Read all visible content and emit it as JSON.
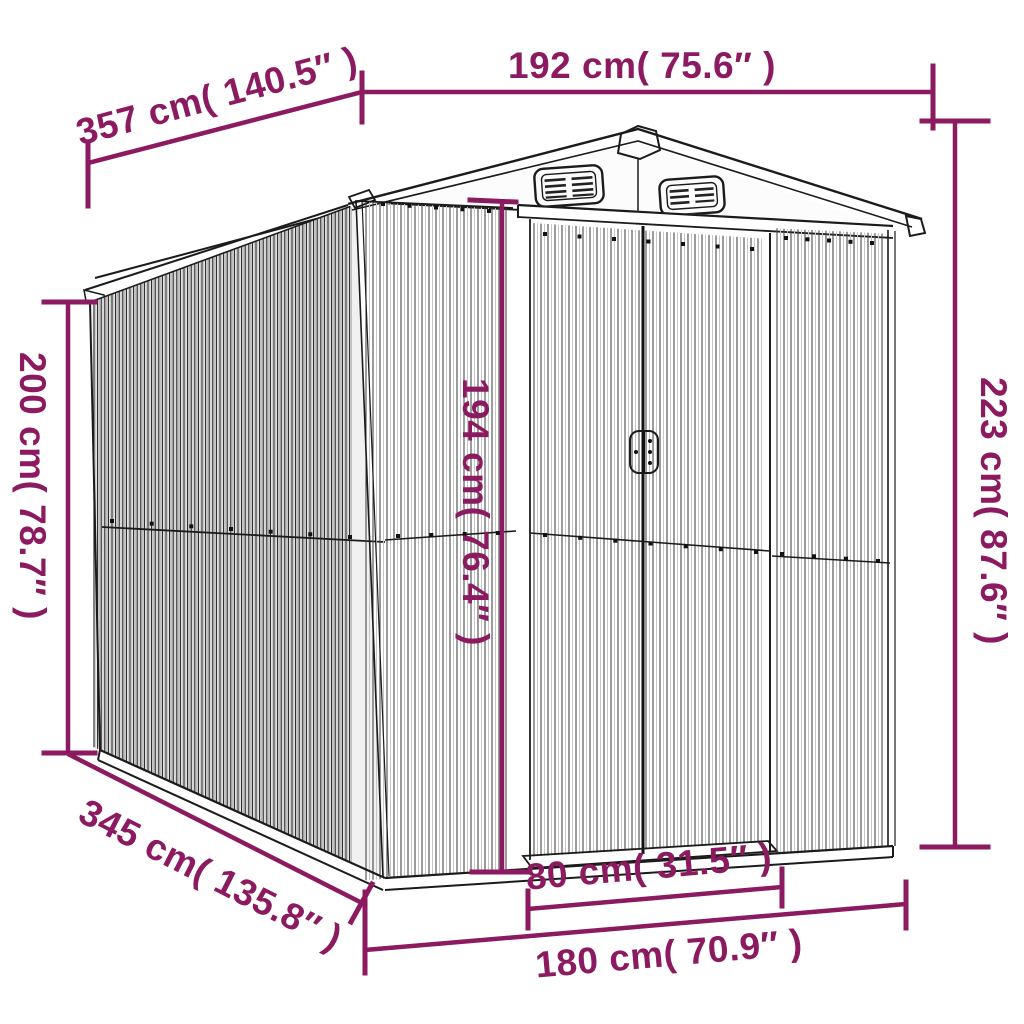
{
  "diagram": {
    "title": "garden-shed-dimension-diagram",
    "background_color": "#ffffff",
    "accent_color": "#8B1A60",
    "line_color": "#1b1b1b",
    "labels": {
      "roof_width": "192 cm( 75.6″ )",
      "diagonal_depth_top": "357 cm( 140.5″ )",
      "wall_height_left": "200 cm( 78.7″ )",
      "total_height_right": "223 cm( 87.6″ )",
      "door_height": "194 cm( 76.4″ )",
      "diagonal_depth_bottom": "345 cm( 135.8″ )",
      "door_width": "80 cm( 31.5″ )",
      "base_width": "180 cm( 70.9″ )"
    }
  }
}
